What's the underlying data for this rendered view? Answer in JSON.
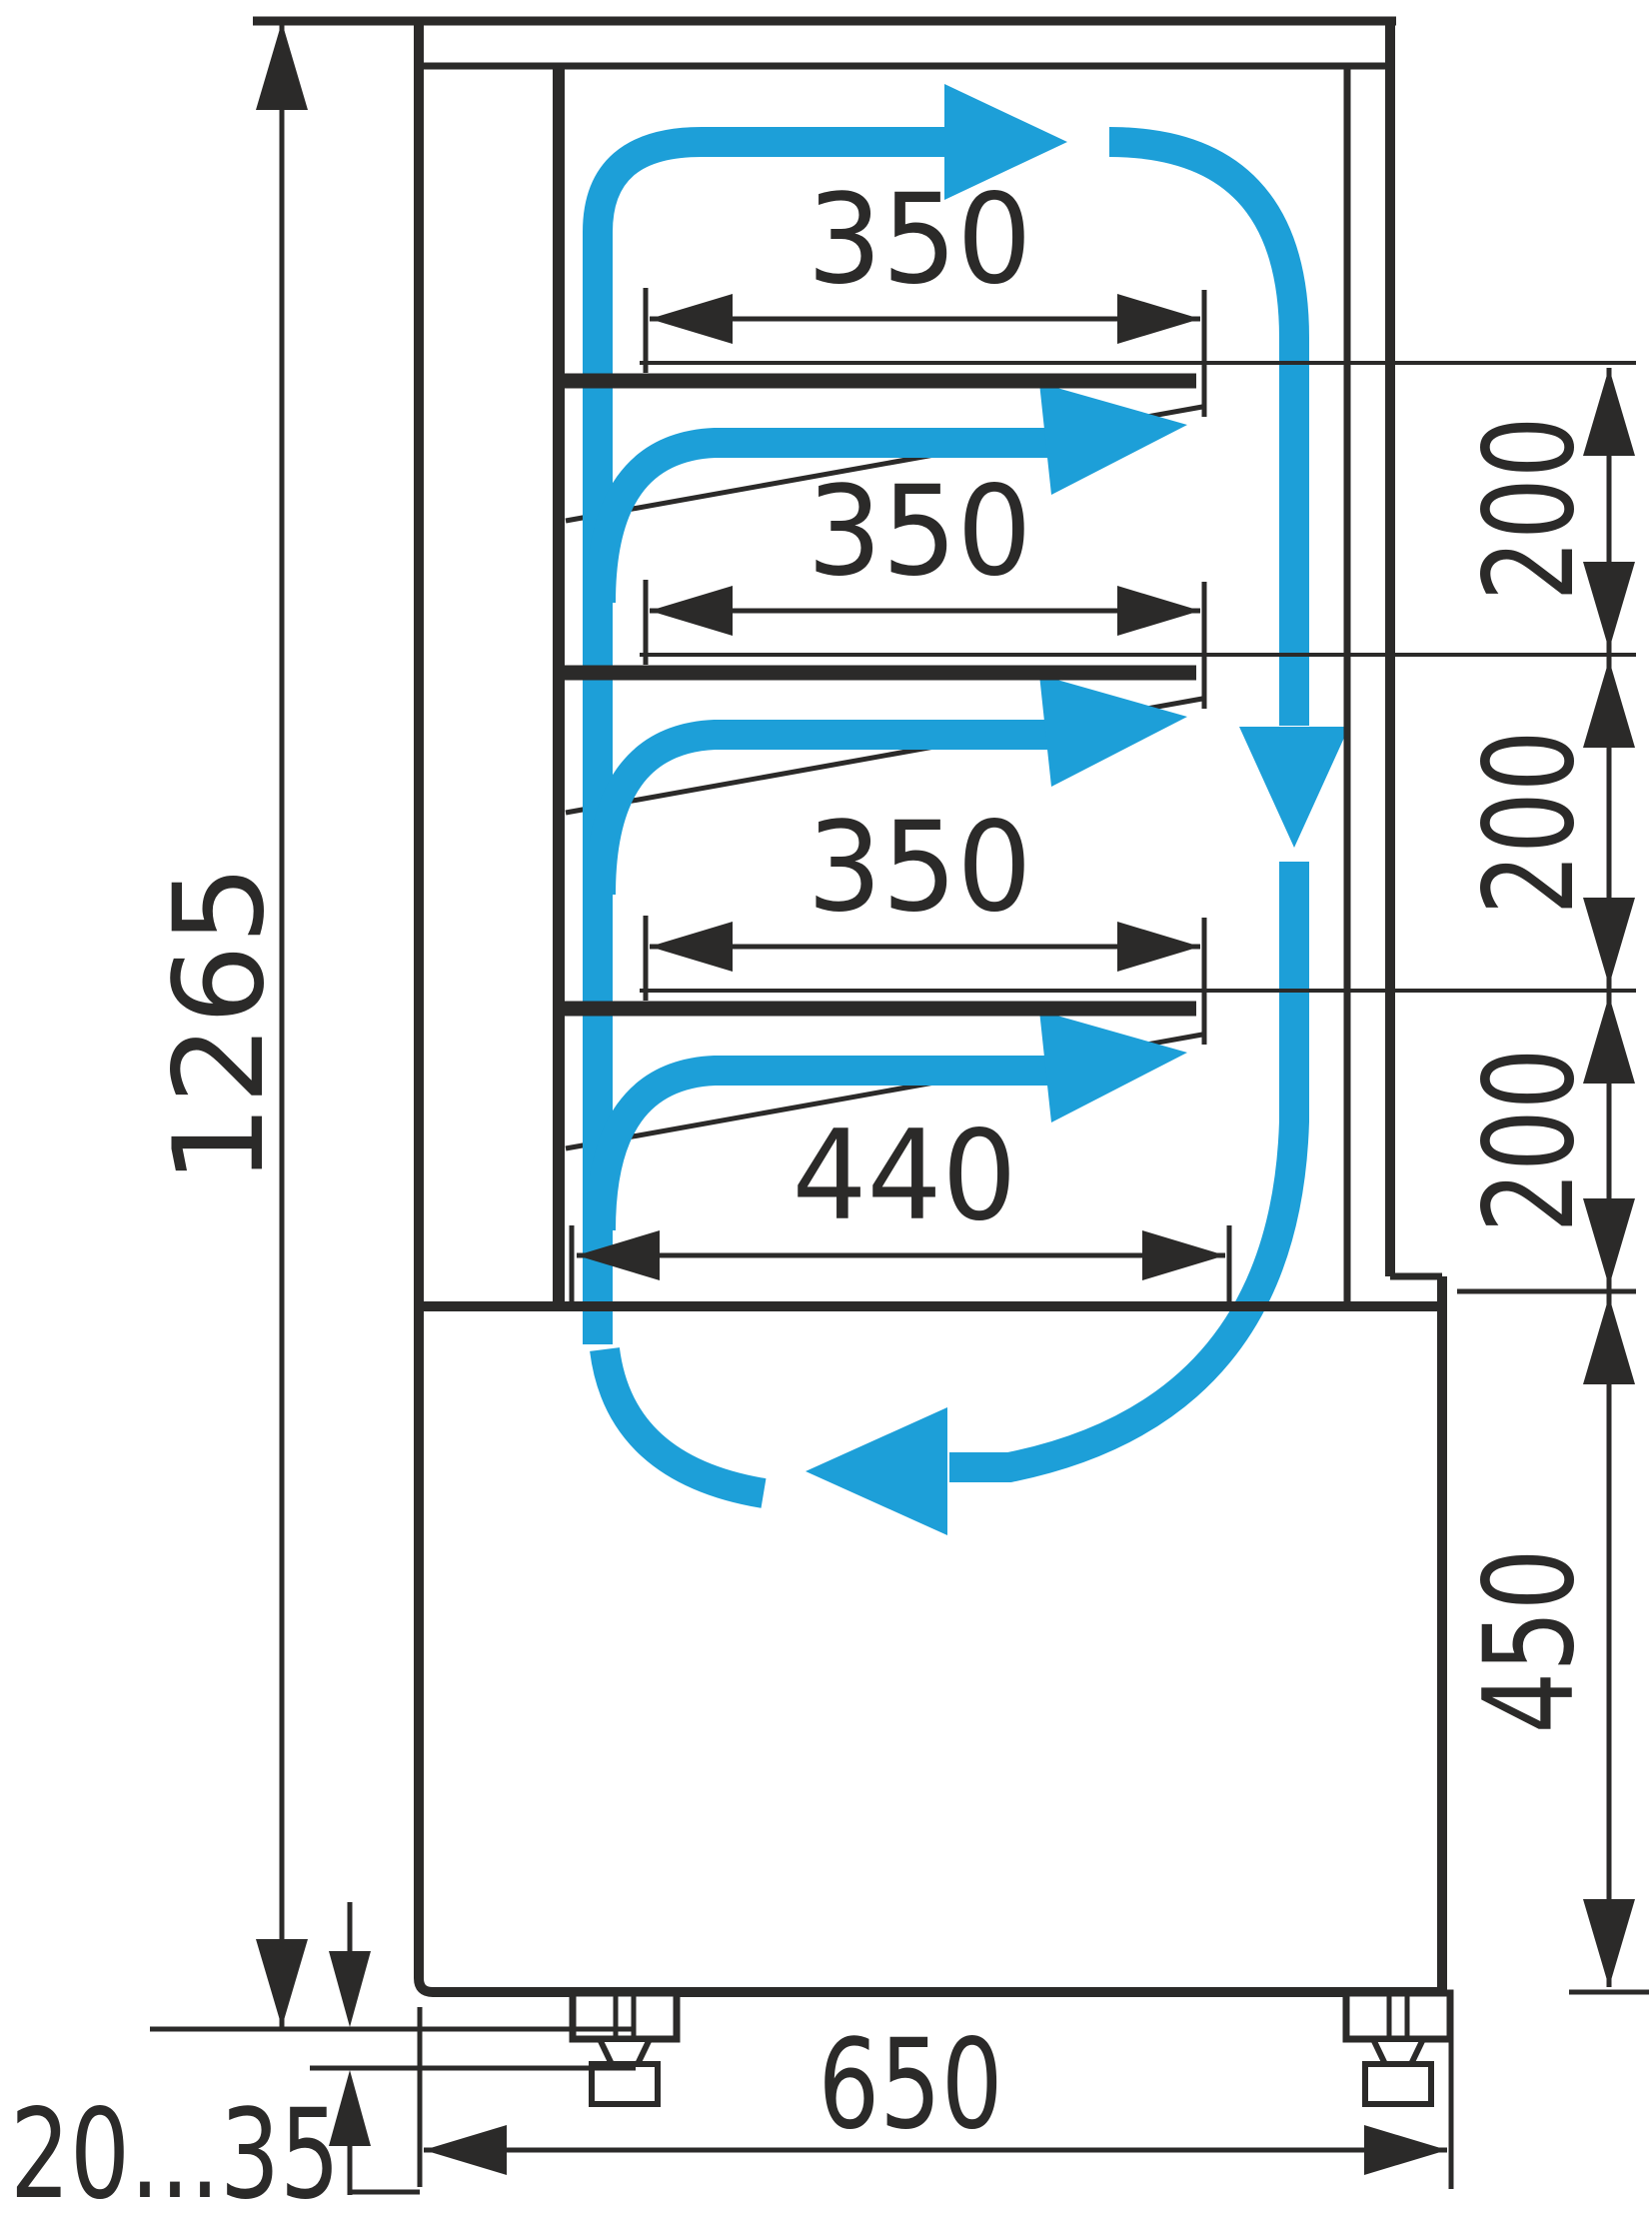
{
  "diagram": {
    "title": "refrigerated-display-case-side-section-airflow",
    "colors": {
      "line": "#2b2a29",
      "accent": "#1d9fd8",
      "background": "#ffffff"
    },
    "dimensions": {
      "total_height": "1265",
      "shelf_width_1": "350",
      "shelf_width_2": "350",
      "shelf_width_3": "350",
      "well_width": "440",
      "shelf_spacing_1": "200",
      "shelf_spacing_2": "200",
      "shelf_spacing_3": "200",
      "base_height": "450",
      "base_width": "650",
      "foot_adjust_range": "20...35"
    }
  }
}
